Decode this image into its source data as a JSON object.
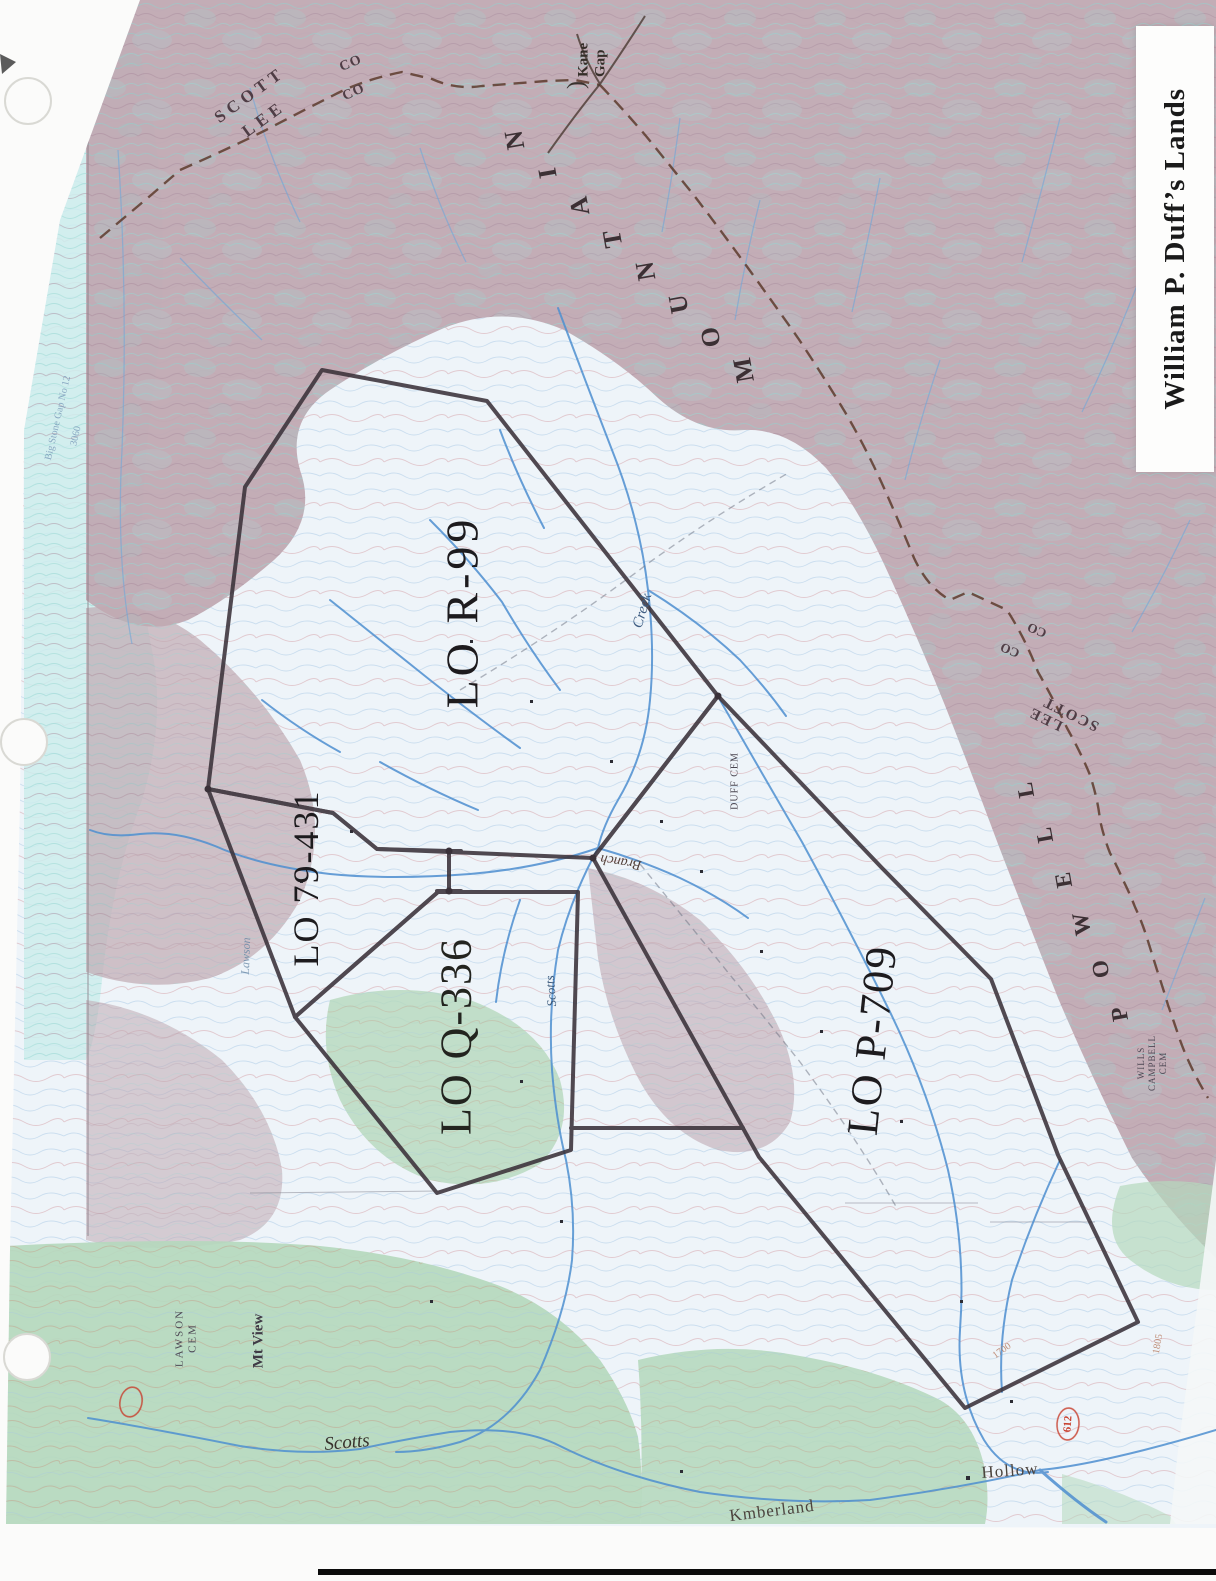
{
  "title": {
    "text": "William P. Duff’s Lands"
  },
  "parcels": [
    {
      "label": "LO R-99"
    },
    {
      "label": "LO 79-431"
    },
    {
      "label": "LO Q-336"
    },
    {
      "label": "LO P-709"
    }
  ],
  "labels": {
    "scott_top": "SCOTT",
    "lee_top": "LEE",
    "co_top_1": "CO",
    "co_top_2": "CO",
    "kane_brace": ")",
    "kane_gap": "Kane Gap",
    "mountain": "MOUNTAIN",
    "powell": "POWELL",
    "lee_right": "LEE",
    "scott_right": "SCOTT",
    "co_right_1": "CO",
    "co_right_2": "CO",
    "creek": "Creek",
    "branch": "Branch",
    "duff_cem": "DUFF CEM",
    "scotts_creek": "Scotts",
    "lawson": "Lawson",
    "lawson_cem": "LAWSON CEM",
    "mt_view": "Mt View",
    "scotts_valley": "Scotts",
    "kimberland": "Kmberland",
    "hollow": "Hollow",
    "wills_campbell_cem": "WILLS CAMPBELL CEM",
    "big_stone_gap": "Big Stone Gap No 12",
    "elev_3060": "3060",
    "route_612": "612",
    "contour_1700": "1700",
    "contour_1805": "1805"
  },
  "colors": {
    "parcel_line": "#3a3139",
    "county_line": "#5d3b2d",
    "stream": "#4e8fd0",
    "woodland_green": "#b5d8bd",
    "mountain_mauve": "#c0a9b2",
    "valley_tint": "#eef4f9",
    "route_red": "#c8402f",
    "ink": "#1d1b1e"
  }
}
